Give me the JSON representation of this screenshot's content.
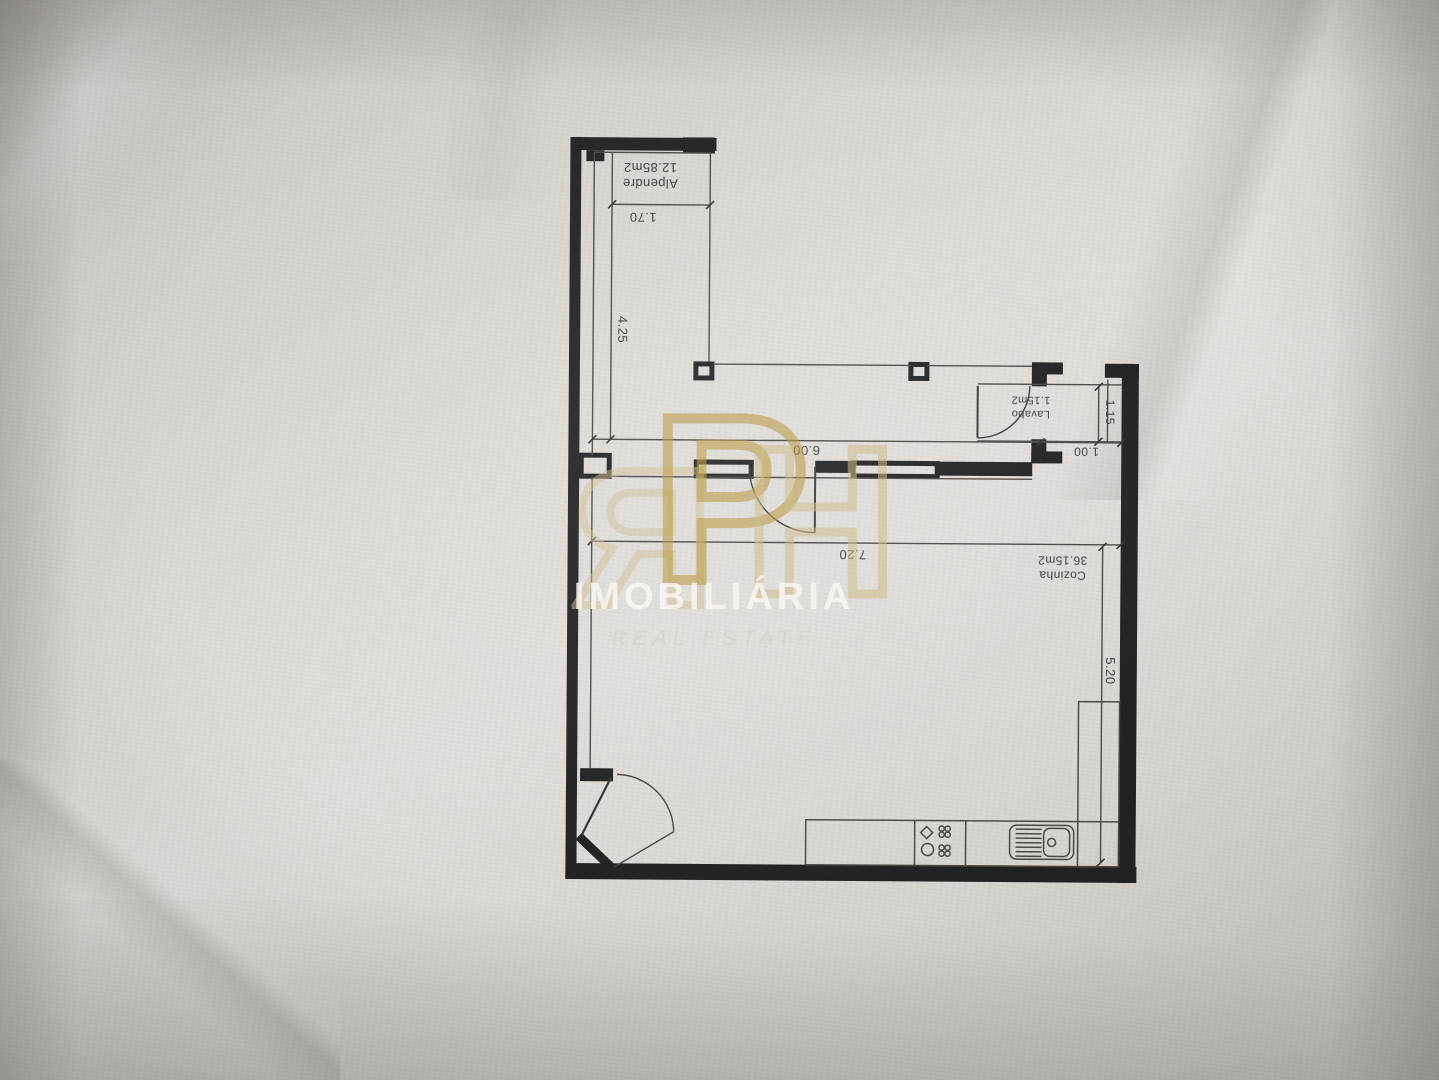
{
  "plan": {
    "rooms": {
      "alpendre": {
        "name": "Alpendre",
        "area": "12.85m2"
      },
      "lavabo": {
        "name": "Lavabo",
        "area": "1.15m2"
      },
      "cozinha": {
        "name": "Cozinha",
        "area": "36.15m2"
      }
    },
    "dimensions": {
      "alpendre_width": "1.70",
      "alpendre_length": "4.25",
      "terrace_width": "6.00",
      "lavabo_depth": "1.15",
      "lavabo_width": "1.00",
      "cozinha_width": "7.20",
      "cozinha_depth": "5.20"
    }
  },
  "watermark": {
    "logo_letters": {
      "r": "R",
      "p": "P",
      "h": "H"
    },
    "brand": "IMOBILIÁRIA",
    "tagline": "REAL ESTATE",
    "colors": {
      "gold": "#bfa04a",
      "tan": "#d2c293",
      "brand_text": "#f7f4ef",
      "wall_ink": "#212121"
    }
  }
}
